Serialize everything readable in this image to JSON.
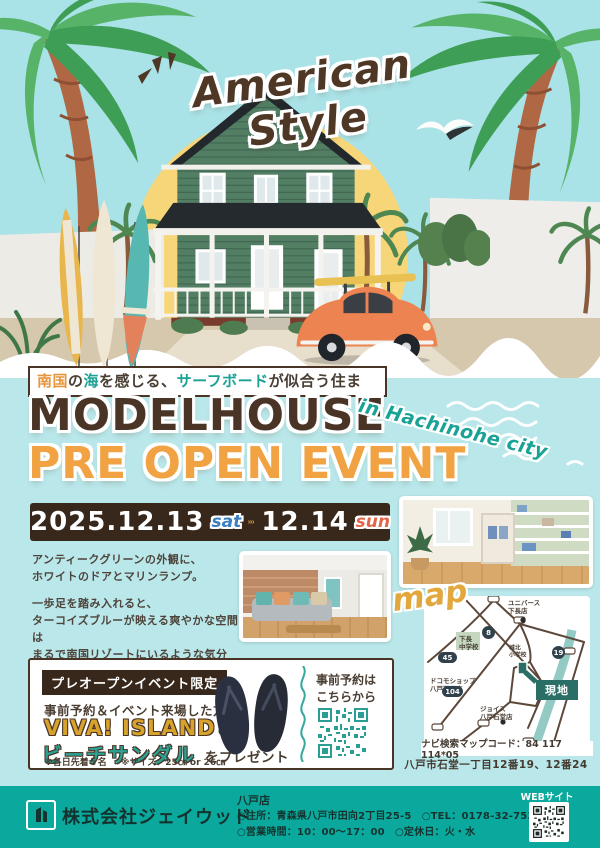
{
  "hero": {
    "title": "American Style"
  },
  "tagline": {
    "part1": "南国",
    "part2": "の",
    "part3": "海",
    "part4": "を感じる、",
    "part5": "サーフボード",
    "part6": "が似合う住まい。"
  },
  "title": {
    "line1": "MODELHOUSE",
    "line2": "PRE OPEN EVENT",
    "location": "in Hachinohe city"
  },
  "dates": {
    "date1": "2025.12.13",
    "day1": "sat",
    "date2": "12.14",
    "day2": "sun"
  },
  "body": {
    "paragraphs": [
      [
        "アンティークグリーンの外観に、",
        "ホワイトのドアとマリンランプ。"
      ],
      [
        "一歩足を踏み入れると、",
        "ターコイズブルーが映える爽やかな空間は",
        "まるで南国リゾートにいるような気分に。"
      ],
      [
        "海を感じる暮らしを",
        "新しいモデルハウスでご体感ください。"
      ]
    ]
  },
  "map": {
    "label": "map",
    "landmarks": [
      {
        "name": "ユニバース\n下長店"
      },
      {
        "name": "下長\n中学校"
      },
      {
        "name": "ドコモショップ\n八戸下長店"
      },
      {
        "name": "ジョイス\n八戸石堂店"
      },
      {
        "name": "城北\n小学校"
      }
    ],
    "routes": [
      "45",
      "8",
      "19",
      "104"
    ],
    "site_label": "現地",
    "navi_code": "ナビ検索マップコード：84 117 114*05",
    "address": "八戸市石堂一丁目12番19、12番24"
  },
  "event": {
    "badge": "プレオープンイベント限定",
    "line1": "事前予約＆イベント来場した方に",
    "brand": "VIVA! ISLAND",
    "brand_suffix": "の",
    "product": "ビーチサンダル",
    "product_suffix": "をプレゼント",
    "note1": "※各日先着５名",
    "note2": "※サイズ：25㎝ or 26㎝",
    "reserve_label": "事前予約は\nこちらから"
  },
  "footer": {
    "company": "株式会社ジェイウッド",
    "shop": "八戸店",
    "info1": "○住所：青森県八戸市田向2丁目25-5　○TEL：0178-32-7530",
    "info2": "○営業時間：10：00～17：00　○定休日：火・水",
    "web_label": "WEBサイト"
  },
  "icons": {
    "arrows": "triple-chevron-right",
    "seagull": "seagull",
    "reserve_qr": "qr-code",
    "web_qr": "qr-code",
    "logo": "company-building-logo"
  },
  "colors": {
    "sky": "#a9e2e7",
    "body_bg": "#b9e7ea",
    "sun": "#f7d67a",
    "brown": "#4a3426",
    "date_bar": "#38281c",
    "orange": "#f1a243",
    "teal": "#19a296",
    "sat_blue": "#3c7fc0",
    "sun_red": "#e0674a",
    "footer": "#0ba99d"
  }
}
